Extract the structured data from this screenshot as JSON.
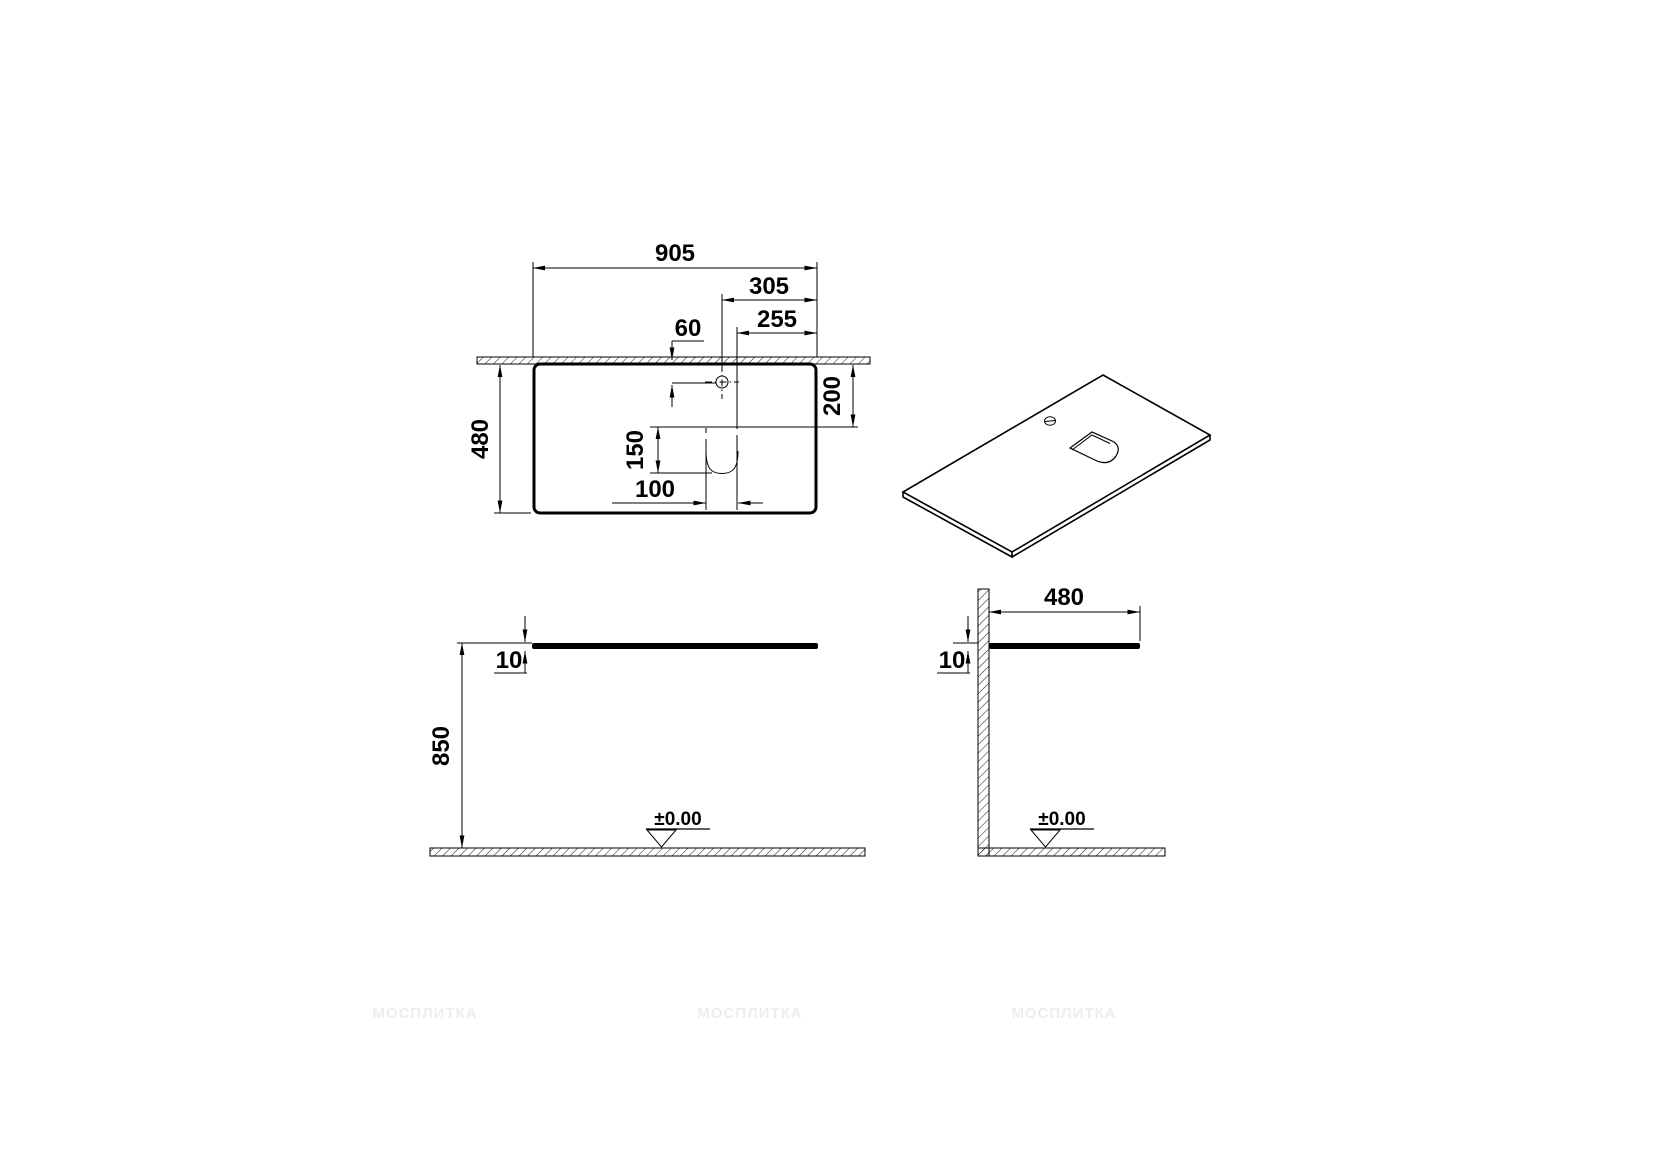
{
  "dims": {
    "top_width": "905",
    "hole_offset_right": "305",
    "cutout_offset_right": "255",
    "hole_offset_wall": "60",
    "top_depth": "480",
    "cutout_offset_wall": "200",
    "cutout_length": "150",
    "cutout_width": "100",
    "front_thickness": "10",
    "front_height": "850",
    "side_depth": "480",
    "side_thickness": "10"
  },
  "levels": {
    "front": "±0.00",
    "side": "±0.00"
  },
  "watermark": {
    "text": "МОСПЛИТКА",
    "color": "#efecec"
  },
  "colors": {
    "line": "#000000",
    "background": "#ffffff"
  }
}
